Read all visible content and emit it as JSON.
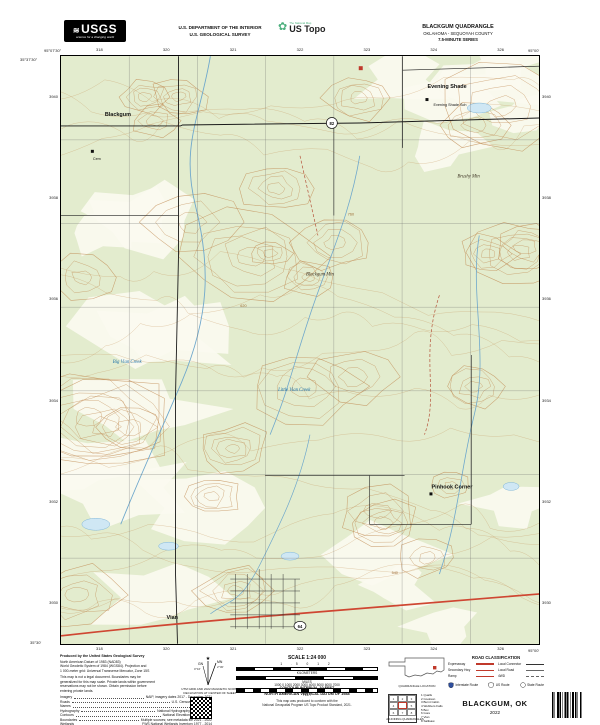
{
  "header": {
    "usgs_wordmark": "USGS",
    "usgs_tagline": "science for a changing world",
    "dept_line1": "U.S. DEPARTMENT OF THE INTERIOR",
    "dept_line2": "U.S. GEOLOGICAL SURVEY",
    "ustopo_small": "The National Map",
    "ustopo_brand": "US Topo",
    "quad_title": "BLACKGUM QUADRANGLE",
    "quad_subtitle": "OKLAHOMA - SEQUOYAH COUNTY",
    "quad_series": "7.5-MINUTE SERIES"
  },
  "map": {
    "collar": {
      "top_ticks": [
        "318",
        "320",
        "321",
        "322",
        "323",
        "324",
        "326"
      ],
      "bottom_ticks": [
        "318",
        "320",
        "321",
        "322",
        "323",
        "324",
        "326"
      ],
      "left_ticks": [
        "3940",
        "3938",
        "3936",
        "3934",
        "3932",
        "3930"
      ],
      "right_ticks": [
        "3940",
        "3938",
        "3936",
        "3934",
        "3932",
        "3930"
      ],
      "corner_tl_lon": "95°07'30\"",
      "corner_tl_lat": "35°37'30\"",
      "corner_tr_lon": "95°00'",
      "corner_bl_lat": "35°30'",
      "corner_br_lon": "95°00'"
    },
    "shields": [
      "82",
      "64"
    ],
    "labels": [
      {
        "text": "Blackgum",
        "x": 44,
        "y": 60,
        "cls": "place"
      },
      {
        "text": "Evening Shade",
        "x": 368,
        "y": 32,
        "cls": "place"
      },
      {
        "text": "Evening Shade Sch",
        "x": 374,
        "y": 50,
        "cls": "small"
      },
      {
        "text": "Cem",
        "x": 32,
        "y": 104,
        "cls": "small"
      },
      {
        "text": "Blackgum Mtn",
        "x": 246,
        "y": 220,
        "cls": "terrain"
      },
      {
        "text": "Brushy Mtn",
        "x": 398,
        "y": 122,
        "cls": "terrain"
      },
      {
        "text": "Little Vian Creek",
        "x": 218,
        "y": 336,
        "cls": "water"
      },
      {
        "text": "Big Vian Creek",
        "x": 52,
        "y": 308,
        "cls": "water"
      },
      {
        "text": "Pinhook Corner",
        "x": 372,
        "y": 434,
        "cls": "place"
      },
      {
        "text": "Vian",
        "x": 106,
        "y": 565,
        "cls": "place"
      },
      {
        "text": "760",
        "x": 288,
        "y": 160,
        "cls": "contour"
      },
      {
        "text": "620",
        "x": 180,
        "y": 252,
        "cls": "contour"
      },
      {
        "text": "540",
        "x": 332,
        "y": 520,
        "cls": "contour"
      }
    ]
  },
  "footer": {
    "produced_by": "Produced by the United States Geological Survey",
    "datum_lines": [
      "North American Datum of 1983 (NAD83)",
      "World Geodetic System of 1984 (WGS84). Projection and",
      "1 000-meter grid: Universal Transverse Mercator, Zone 15S"
    ],
    "disclaimer_lines": [
      "This map is not a legal document. Boundaries may be",
      "generalized for this map scale. Private lands within government",
      "reservations may not be shown. Obtain permission before",
      "entering private lands."
    ],
    "sources": [
      {
        "label": "Imagery",
        "value": "NAIP, imagery dates 2017 - December 2021"
      },
      {
        "label": "Roads",
        "value": "U.S. Census Bureau, 2021"
      },
      {
        "label": "Names",
        "value": "GNIS, 2022"
      },
      {
        "label": "Hydrography",
        "value": "National Hydrography Dataset, 2022"
      },
      {
        "label": "Contours",
        "value": "National Elevation Dataset, 2022"
      },
      {
        "label": "Boundaries",
        "value": "Multiple sources; see metadata file 2021 - 2022"
      },
      {
        "label": "Wetlands",
        "value": "FWS National Wetlands Inventory 1977 - 2014"
      }
    ],
    "declination": {
      "gn_label": "GN",
      "mn_label": "MN",
      "gn_angle": "0°16'",
      "mn_angle": "2°30'",
      "caption_line1": "UTM GRID AND 2022 MAGNETIC NORTH",
      "caption_line2": "DECLINATION AT CENTER OF SHEET"
    },
    "scale": {
      "title": "SCALE 1:24 000",
      "km_ticks": "1   .5   0   1   2",
      "km_label": "KILOMETERS",
      "mi_ticks": "1   .5   0   1",
      "mi_label": "MILES",
      "ft_ticks": "1000  0  1000  2000  3000  4000  5000  6000  7000",
      "ft_label": "FEET",
      "contour_interval": "CONTOUR INTERVAL 10 FEET",
      "vertical_datum": "NORTH AMERICAN VERTICAL DATUM OF 1988",
      "conform_line1": "This map was produced to conform with the",
      "conform_line2": "National Geospatial Program US Topo Product Standard, 2021."
    },
    "locator_caption": "QUADRANGLE LOCATION",
    "road_class": {
      "title": "ROAD CLASSIFICATION",
      "col1": [
        "Expressway",
        "Secondary Hwy",
        "Ramp"
      ],
      "col2": [
        "Local Connector",
        "Local Road",
        "4WD"
      ],
      "shield_items": [
        "Interstate Route",
        "US Route",
        "State Route"
      ]
    },
    "adjoining": {
      "cell_numbers": [
        "1",
        "2",
        "3",
        "4",
        "",
        "5",
        "6",
        "7",
        "8"
      ],
      "names": [
        "1 Qualls",
        "2 Cookson",
        "3 Burnt Cabin",
        "4 Webbers Falls",
        "5 Box",
        "6 Gore",
        "7 Vian",
        "8 Sallisaw"
      ],
      "caption": "ADJOINING QUADRANGLES"
    },
    "title_name": "BLACKGUM, OK",
    "title_year": "2022",
    "side_text": "BLACKGUM, OK"
  }
}
